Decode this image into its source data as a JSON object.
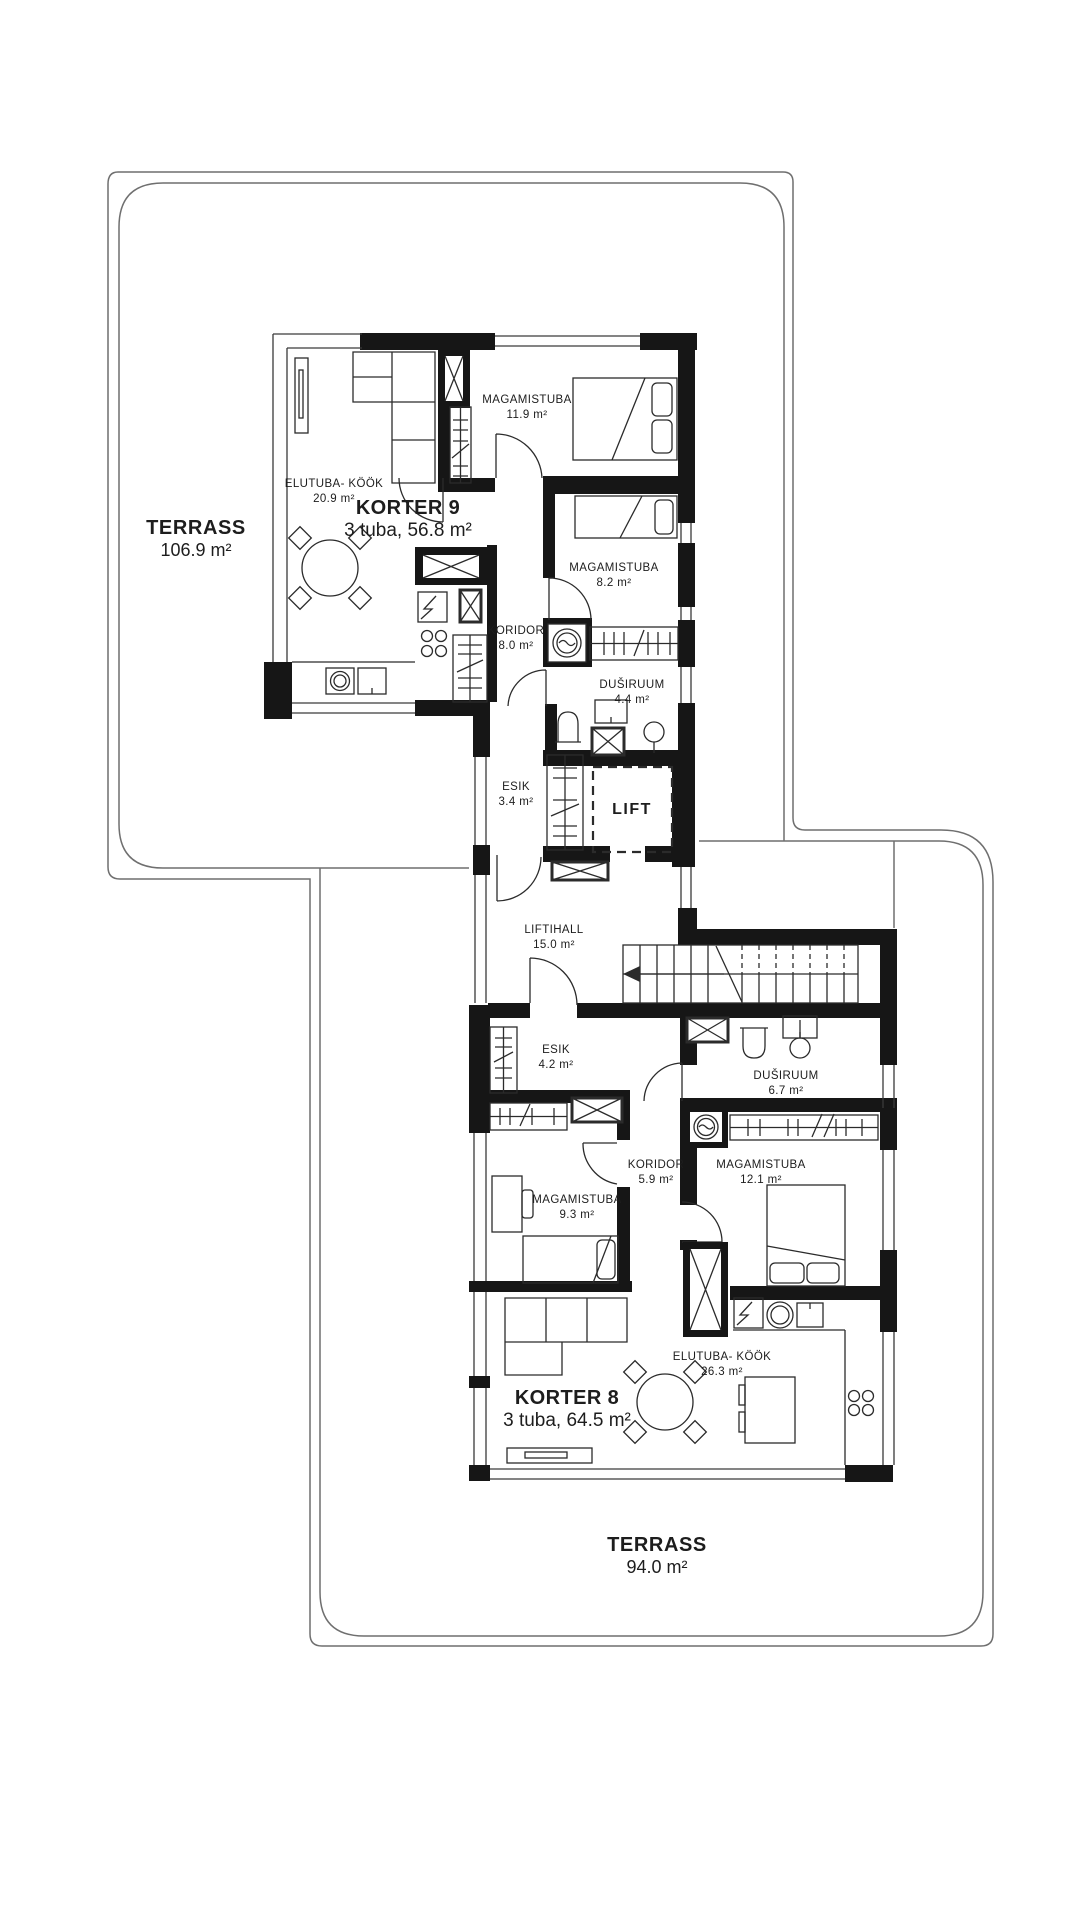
{
  "terraces": [
    {
      "name": "TERRASS",
      "area": "106.9 m²"
    },
    {
      "name": "TERRASS",
      "area": "94.0 m²"
    }
  ],
  "apartments": [
    {
      "name": "KORTER 9",
      "info": "3 tuba, 56.8 m²",
      "rooms": [
        {
          "name": "ELUTUBA- KÖÖK",
          "area": "20.9 m²"
        },
        {
          "name": "MAGAMISTUBA",
          "area": "11.9 m²"
        },
        {
          "name": "MAGAMISTUBA",
          "area": "8.2 m²"
        },
        {
          "name": "KORIDOR",
          "area": "8.0 m²"
        },
        {
          "name": "DUŠIRUUM",
          "area": "4.4 m²"
        },
        {
          "name": "ESIK",
          "area": "3.4 m²"
        }
      ]
    },
    {
      "name": "KORTER 8",
      "info": "3 tuba, 64.5 m²",
      "rooms": [
        {
          "name": "ESIK",
          "area": "4.2 m²"
        },
        {
          "name": "DUŠIRUUM",
          "area": "6.7 m²"
        },
        {
          "name": "KORIDOR",
          "area": "5.9 m²"
        },
        {
          "name": "MAGAMISTUBA",
          "area": "12.1 m²"
        },
        {
          "name": "MAGAMISTUBA",
          "area": "9.3 m²"
        },
        {
          "name": "ELUTUBA- KÖÖK",
          "area": "26.3 m²"
        }
      ]
    }
  ],
  "common": {
    "lift": "LIFT",
    "lifthall": {
      "name": "LIFTIHALL",
      "area": "15.0 m²"
    }
  },
  "colors": {
    "wall": "#161616",
    "furniture_line": "#2b2b2b",
    "terrace_line": "#6f6f6f",
    "text": "#1d1d1d",
    "background": "#ffffff"
  }
}
